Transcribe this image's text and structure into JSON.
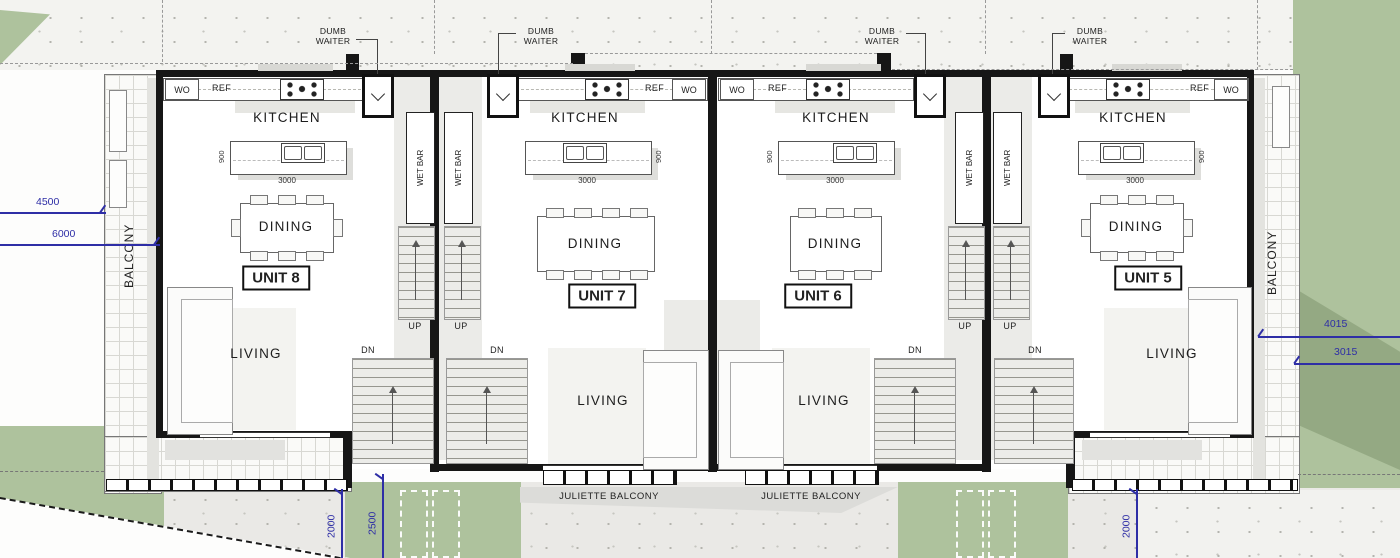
{
  "labels": {
    "kitchen": "KITCHEN",
    "dining": "DINING",
    "living": "LIVING",
    "balcony": "BALCONY",
    "juliette_balcony": "JULIETTE BALCONY",
    "wet_bar": "WET BAR",
    "dumb_waiter": "DUMB WAITER",
    "up": "UP",
    "dn": "DN",
    "wo": "WO",
    "ref": "REF"
  },
  "units": [
    {
      "name": "UNIT 8"
    },
    {
      "name": "UNIT 7"
    },
    {
      "name": "UNIT 6"
    },
    {
      "name": "UNIT 5"
    }
  ],
  "island": {
    "depth": "900",
    "width": "3000"
  },
  "dims": {
    "left": [
      "4500",
      "6000"
    ],
    "right": [
      "4015",
      "3015"
    ],
    "bottom": [
      "2000",
      "2500",
      "2000"
    ]
  },
  "colors": {
    "landscape_green": "#aec29d",
    "landscape_green_shadow": "#94a983",
    "dimension_blue": "#2e2ea6",
    "wall_black": "#161616"
  }
}
